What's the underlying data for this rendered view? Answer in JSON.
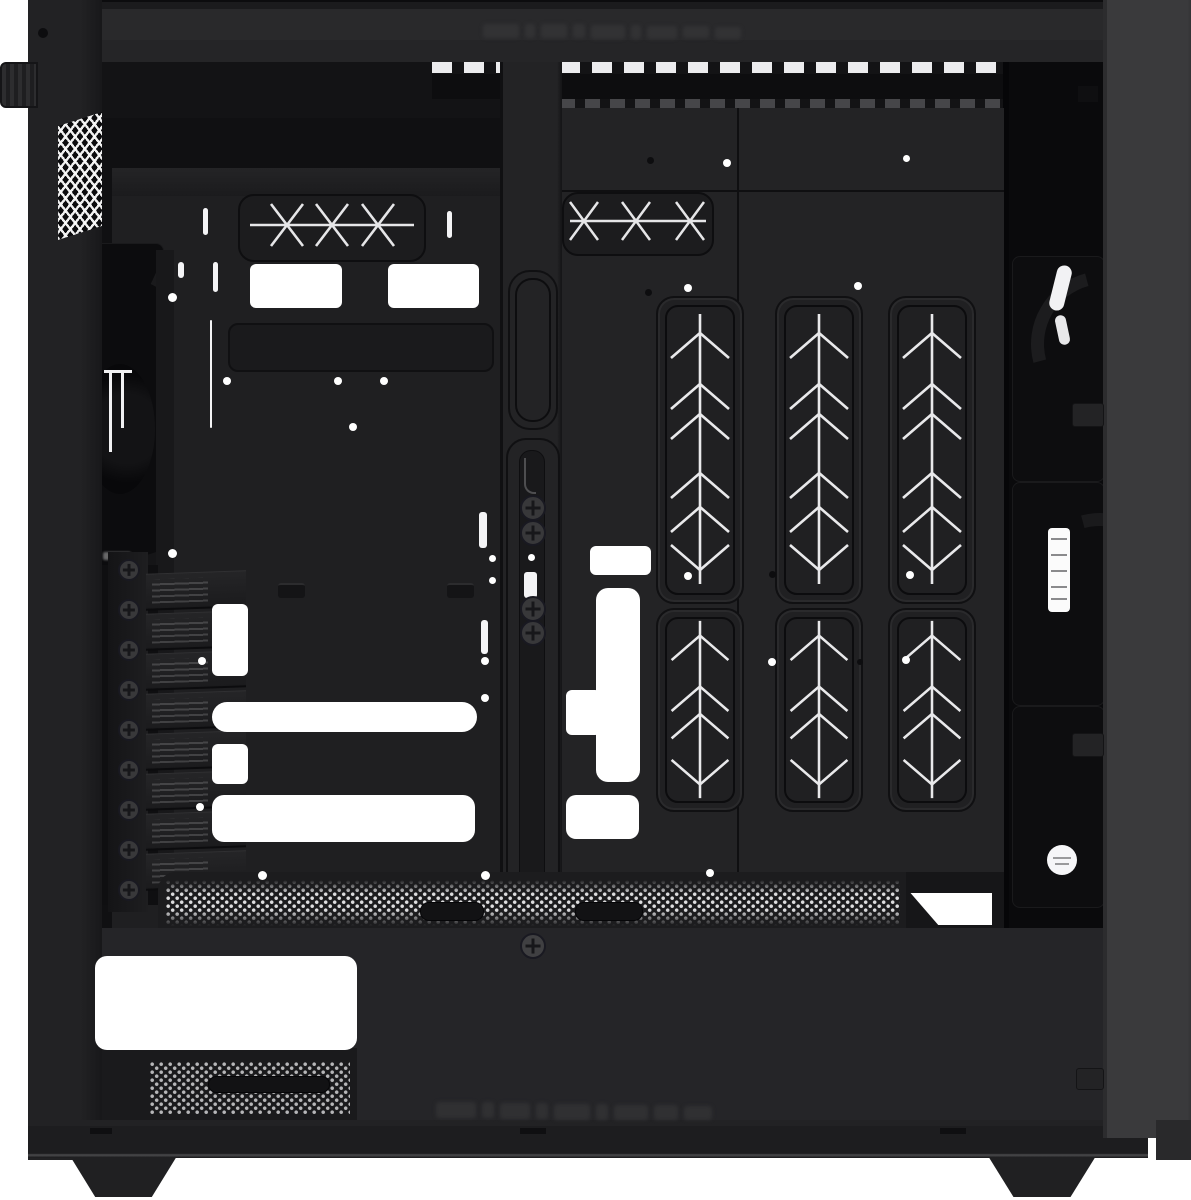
{
  "scene": {
    "type": "product-photo",
    "subject": "Black mid-tower ATX PC case shown from the open left side, side panel removed, empty interior",
    "background": "#ffffff",
    "legible_text": "none (only faint illegible embossed branding on top and bottom front rails)"
  },
  "colors": {
    "background": "#ffffff",
    "frame": "#202022",
    "top_frame": "#272729",
    "side_panel_gray": "#3a3a3c",
    "wall_left": "#1f1f21",
    "wall_right": "#232325",
    "recess_panel": "#1c1c1e",
    "deep_shadow": "#0a0a0c",
    "pattern_lines": "#e9e9eb",
    "cutout_white": "#ffffff",
    "screw_gray": "#38383a"
  },
  "counts": {
    "pci_expansion_slots": 8,
    "chevron_vent_panels_tall": 3,
    "chevron_vent_panels_short": 3,
    "x_pattern_vents": 2,
    "case_feet": 2,
    "side_panel_tabs": 3,
    "visible_fans_right": 3,
    "front_fan": 1
  },
  "decor": {
    "white_rects": [
      [
        250,
        264,
        92,
        44,
        6
      ],
      [
        388,
        264,
        91,
        44,
        6
      ],
      [
        212,
        604,
        36,
        72,
        6
      ],
      [
        212,
        702,
        265,
        30,
        15
      ],
      [
        212,
        744,
        36,
        40,
        6
      ],
      [
        212,
        795,
        263,
        47,
        12
      ],
      [
        590,
        546,
        61,
        29,
        6
      ],
      [
        596,
        588,
        44,
        194,
        12
      ],
      [
        566,
        690,
        35,
        45,
        6
      ],
      [
        566,
        795,
        73,
        44,
        10
      ],
      [
        95,
        956,
        262,
        94,
        12
      ]
    ],
    "white_dots": [
      [
        172,
        297,
        9
      ],
      [
        172,
        553,
        9
      ],
      [
        227,
        381,
        8
      ],
      [
        338,
        381,
        8
      ],
      [
        384,
        381,
        8
      ],
      [
        353,
        427,
        8
      ],
      [
        202,
        661,
        8
      ],
      [
        485,
        661,
        8
      ],
      [
        485,
        698,
        8
      ],
      [
        200,
        807,
        8
      ],
      [
        262,
        875,
        9
      ],
      [
        485,
        875,
        9
      ],
      [
        492,
        558,
        7
      ],
      [
        492,
        580,
        7
      ],
      [
        531,
        557,
        7
      ],
      [
        727,
        163,
        8
      ],
      [
        906,
        158,
        7
      ],
      [
        688,
        288,
        8
      ],
      [
        858,
        286,
        8
      ],
      [
        688,
        576,
        8
      ],
      [
        910,
        575,
        8
      ],
      [
        772,
        662,
        8
      ],
      [
        906,
        660,
        8
      ],
      [
        710,
        873,
        8
      ],
      [
        147,
        1037,
        8
      ]
    ],
    "dark_dots": [
      [
        43,
        33,
        10
      ],
      [
        650,
        160,
        7
      ],
      [
        648,
        292,
        7
      ],
      [
        772,
        574,
        7
      ],
      [
        860,
        662,
        6
      ]
    ],
    "slits": [
      [
        178,
        262,
        6,
        16
      ],
      [
        203,
        208,
        5,
        27
      ],
      [
        447,
        211,
        5,
        27
      ],
      [
        213,
        262,
        5,
        30
      ],
      [
        479,
        512,
        8,
        36
      ],
      [
        481,
        620,
        7,
        34
      ],
      [
        524,
        572,
        13,
        26
      ]
    ],
    "white_lines": [
      [
        210,
        320,
        2,
        108
      ]
    ],
    "hooks": [
      [
        278,
        583,
        27,
        13
      ],
      [
        447,
        583,
        27,
        13
      ]
    ],
    "handles": [
      [
        420,
        902,
        62,
        17
      ],
      [
        575,
        902,
        66,
        17
      ],
      [
        208,
        1076,
        120,
        15
      ]
    ],
    "rail_screws": [
      [
        531,
        506
      ],
      [
        531,
        531
      ],
      [
        531,
        607
      ],
      [
        531,
        631
      ]
    ],
    "bracket_screw": [
      531,
      944
    ],
    "pci": {
      "screw_x": 127,
      "screw_ys": [
        568,
        608,
        648,
        688,
        728,
        768,
        808,
        848,
        888
      ],
      "cover_x": 146,
      "cover_w": 100,
      "cover_h": 34,
      "cover_ys": [
        572,
        612,
        652,
        692,
        732,
        772,
        812,
        852
      ]
    },
    "emboss_top": [
      [
        483,
        24,
        36,
        14
      ],
      [
        525,
        24,
        10,
        14
      ],
      [
        541,
        24,
        26,
        14
      ],
      [
        573,
        24,
        12,
        14
      ],
      [
        591,
        25,
        34,
        14
      ],
      [
        631,
        25,
        10,
        14
      ],
      [
        647,
        26,
        30,
        13
      ],
      [
        683,
        26,
        26,
        12
      ],
      [
        715,
        27,
        26,
        12
      ]
    ],
    "emboss_bottom": [
      [
        436,
        1102,
        40,
        16
      ],
      [
        482,
        1102,
        12,
        16
      ],
      [
        500,
        1103,
        30,
        16
      ],
      [
        536,
        1103,
        12,
        16
      ],
      [
        554,
        1104,
        36,
        16
      ],
      [
        596,
        1104,
        12,
        16
      ],
      [
        614,
        1105,
        34,
        15
      ],
      [
        654,
        1105,
        24,
        15
      ],
      [
        684,
        1106,
        28,
        14
      ]
    ],
    "fan_labels_right": {
      "tall_label": [
        1048,
        528,
        22,
        84
      ],
      "round_label": [
        1047,
        845,
        30,
        30
      ]
    },
    "side_tabs": [
      [
        1072,
        403,
        30,
        22
      ],
      [
        1072,
        733,
        30,
        22
      ],
      [
        1076,
        1068,
        26,
        20
      ]
    ],
    "rail_clips": [
      [
        90,
        1128,
        22,
        6
      ],
      [
        520,
        1128,
        26,
        6
      ],
      [
        940,
        1128,
        26,
        6
      ]
    ]
  }
}
